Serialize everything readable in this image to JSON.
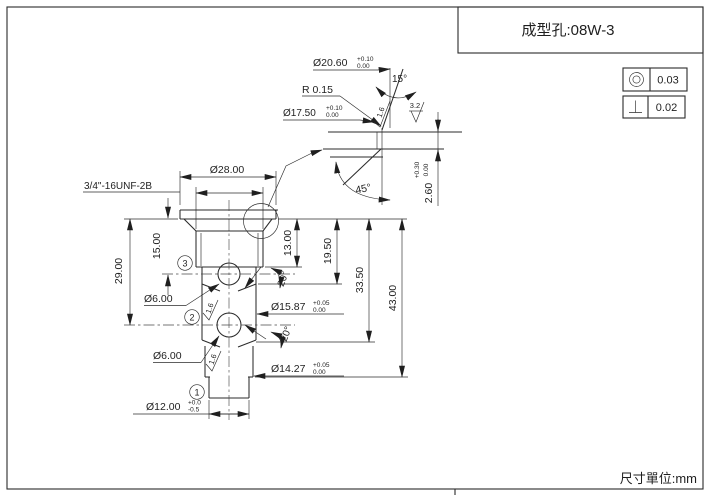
{
  "title_block": {
    "part_label": "成型孔:08W-3"
  },
  "footer": {
    "units_label": "尺寸單位:mm"
  },
  "tolerance_frames": [
    {
      "symbol": "concentricity",
      "value": "0.03"
    },
    {
      "symbol": "perpendicularity",
      "value": "0.02"
    }
  ],
  "main_view": {
    "thread_callout": "3/4\"-16UNF-2B",
    "dia_28": "Ø28.00",
    "len_15": "15.00",
    "len_29": "29.00",
    "len_13": "13.00",
    "len_19_5": "19.50",
    "len_33_5": "33.50",
    "len_43": "43.00",
    "dia_6_upper": "Ø6.00",
    "dia_6_lower": "Ø6.00",
    "dia_15_87": {
      "value": "Ø15.87",
      "tol_upper": "+0.05",
      "tol_lower": "0.00"
    },
    "dia_14_27": {
      "value": "Ø14.27",
      "tol_upper": "+0.05",
      "tol_lower": "0.00"
    },
    "dia_12": {
      "value": "Ø12.00",
      "tol_upper": "+0.0",
      "tol_lower": "-0.5"
    },
    "angle_upper": "20°",
    "angle_lower": "20°",
    "roughness_upper": "1.6",
    "roughness_lower": "1.6",
    "balloon_1": "1",
    "balloon_2": "2",
    "balloon_3": "3"
  },
  "detail_view": {
    "dia_20_60": {
      "value": "Ø20.60",
      "tol_upper": "+0.10",
      "tol_lower": "0.00"
    },
    "radius_label": "R 0.15",
    "dia_17_50": {
      "value": "Ø17.50",
      "tol_upper": "+0.10",
      "tol_lower": "0.00"
    },
    "angle_15": "15°",
    "angle_45": "45°",
    "depth_2_60": {
      "value": "2.60",
      "tol_upper": "+0.30",
      "tol_lower": "0.00"
    },
    "roughness_taper": "1.6",
    "roughness_seat": "3.2"
  }
}
